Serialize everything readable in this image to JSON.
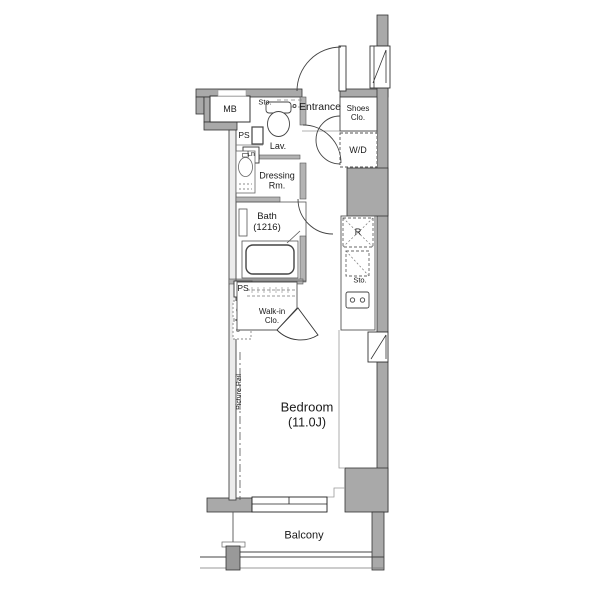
{
  "plan": {
    "labels": {
      "mb": "MB",
      "sto_top": "Sto.",
      "entrance": "Entrance",
      "shoes_line1": "Shoes",
      "shoes_line2": "Clo.",
      "wd": "W/D",
      "ps_upper": "PS",
      "lav": "Lav.",
      "ln": "Ln",
      "dressing_line1": "Dressing",
      "dressing_line2": "Rm.",
      "bath_line1": "Bath",
      "bath_line2": "(1216)",
      "fridge": "R",
      "sto_kitchen": "Sto.",
      "ps_lower": "PS",
      "walkin_line1": "Walk-in",
      "walkin_line2": "Clo.",
      "picture_rail": "Picture Rail",
      "bedroom_line1": "Bedroom",
      "bedroom_line2": "(11.0J)",
      "balcony": "Balcony"
    },
    "colors": {
      "wall": "#a9a9a9",
      "partition": "#b3b3b3",
      "outline": "#333333",
      "background": "#ffffff"
    }
  }
}
